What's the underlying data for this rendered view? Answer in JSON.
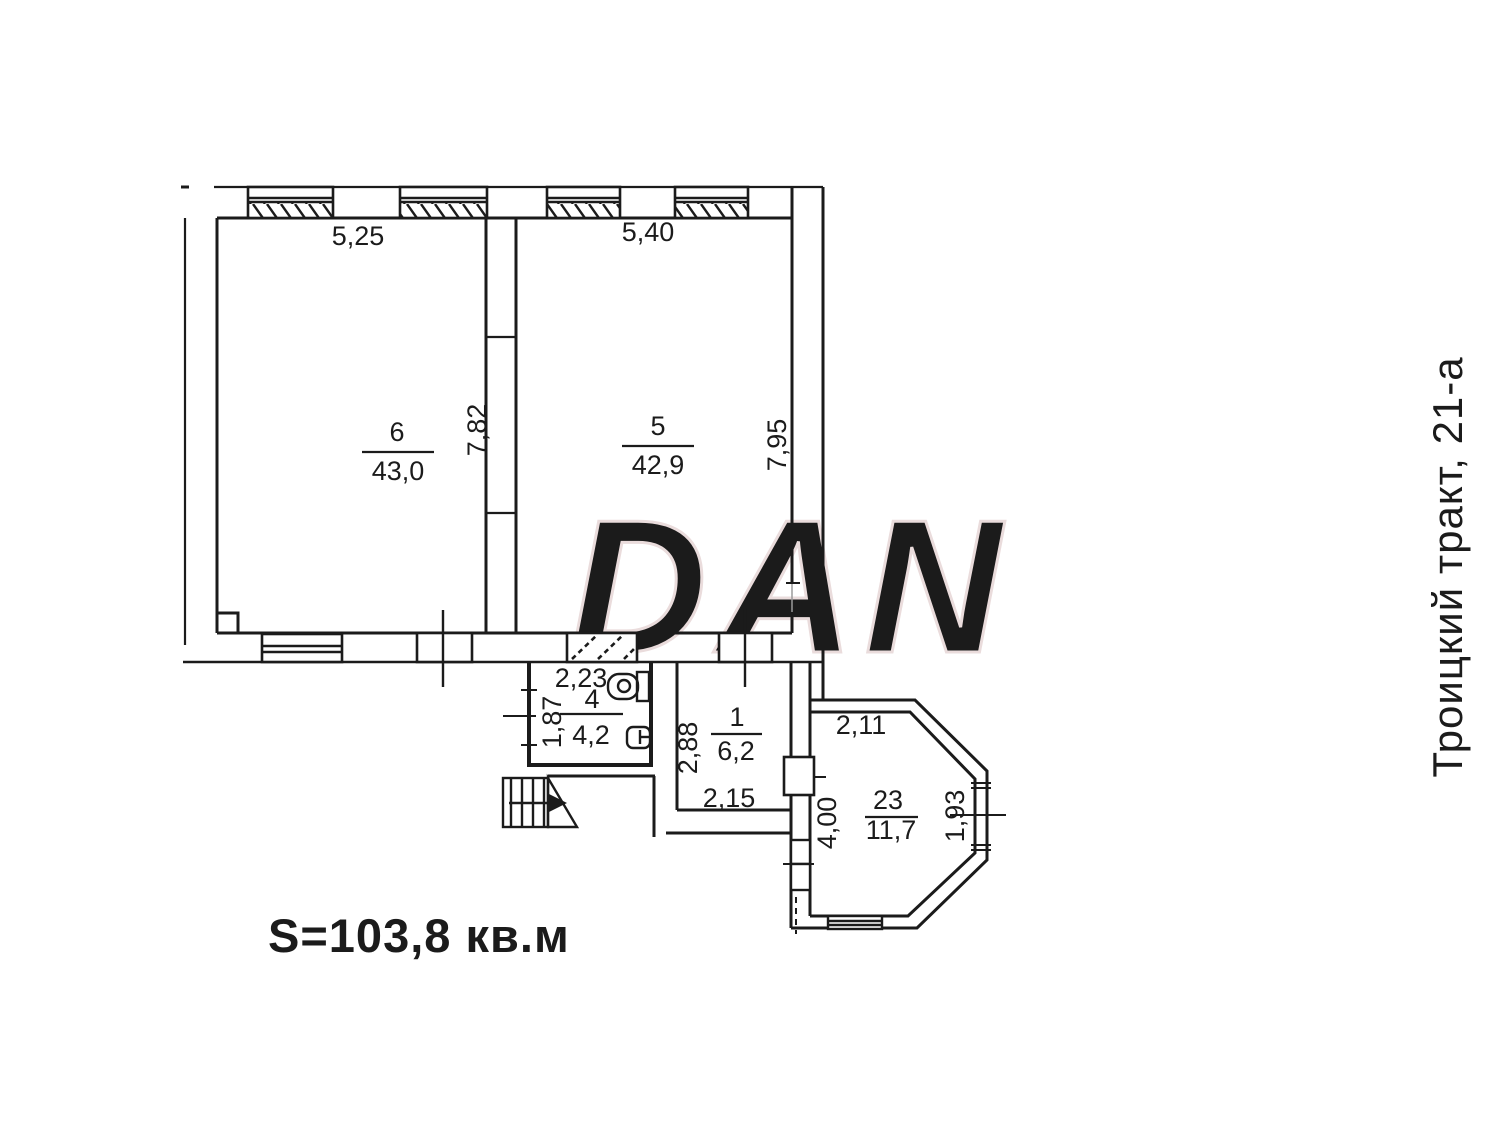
{
  "plan": {
    "address": "Троицкий тракт, 21-а",
    "total_area": "S=103,8 кв.м",
    "watermark": "DAN",
    "colors": {
      "accent_red": "#e32422",
      "line": "#1b1b1b",
      "watermark_stroke": "#eadcdc"
    },
    "rooms": [
      {
        "number": "6",
        "area": "43,0",
        "dim_top": "5,25",
        "dim_side": "7,82"
      },
      {
        "number": "5",
        "area": "42,9",
        "dim_top": "5,40",
        "dim_side": "7,95"
      },
      {
        "number": "4",
        "area": "4,2",
        "dim_top": "2,23",
        "dim_side": "1,87"
      },
      {
        "number": "1",
        "area": "6,2",
        "dim_bottom": "2,15",
        "dim_side": "2,88"
      },
      {
        "number": "23",
        "area": "11,7",
        "dim_top": "2,11",
        "dim_left": "4,00",
        "dim_right": "1,93"
      }
    ]
  }
}
